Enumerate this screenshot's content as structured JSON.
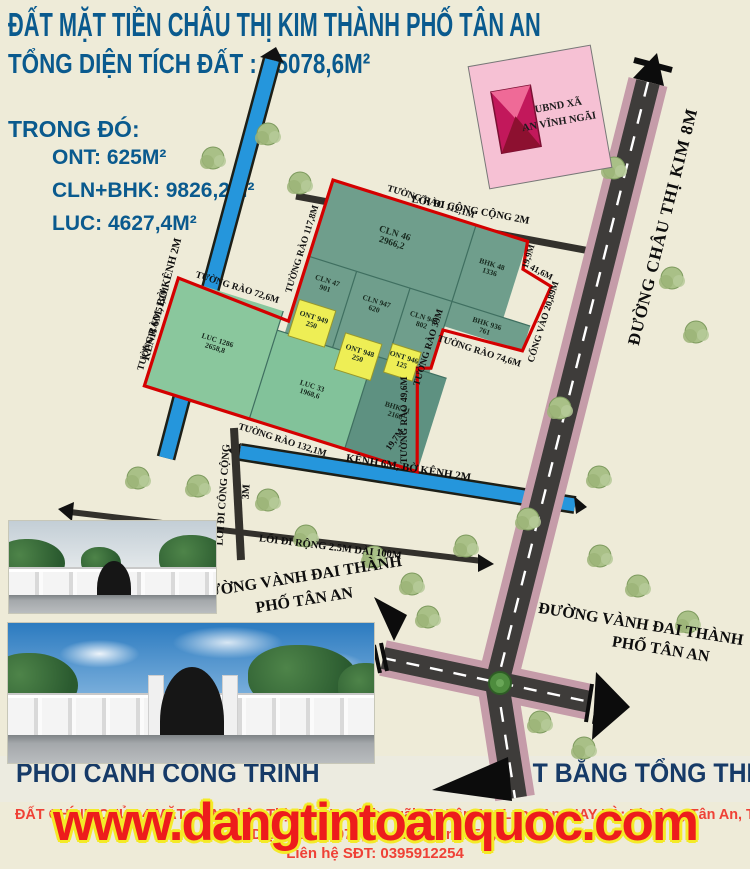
{
  "header": {
    "title": "ĐẤT MẶT TIỀN CHÂU THỊ KIM THÀNH PHỐ TÂN AN",
    "total_area": "TỔNG DIỆN TÍCH ĐẤT : 15078,6M²",
    "breakdown_label": "TRONG ĐÓ:",
    "breakdown": [
      "ONT: 625M²",
      "CLN+BHK: 9826,2M²",
      "LUC: 4627,4M²"
    ]
  },
  "map": {
    "ubnd": {
      "line1": "UBND XÃ",
      "line2": "AN VĨNH NGÃI"
    },
    "roads": {
      "chau_thi_kim": "ĐƯỜNG CHÂU THỊ KIM 8M",
      "vanh_dai_line1": "ĐƯỜNG VÀNH ĐAI THÀNH",
      "vanh_dai_line2": "PHỐ TÂN AN",
      "public_path_2m": "LỐI ĐI CÔNG CỘNG 2M",
      "public_path": "LỐI ĐI CÔNG CỘNG",
      "public_path_width": "3M",
      "canal_left": "KÊNH 6M, BỜ KÊNH 2M",
      "canal_bottom": "KÊNH 6M, BỜ KÊNH 2M",
      "path_100m": "LỐI ĐI RỘNG 2.5M DÀI 100M",
      "gate": "CỔNG VÀO 20,89M"
    },
    "fences": {
      "top": "TƯỜNG RÀO 112,1M",
      "left": "TƯỜNG RÀO 117,8M",
      "luc_top": "TƯỜNG RÀO 72,6M",
      "luc_left": "TƯỜNG RÀO 51,2M",
      "bottom": "TƯỜNG RÀO 132,1M",
      "bhk_bottom": "TƯỜNG RÀO 74,6M",
      "f39": "TƯỜNG RÀO 39M",
      "f49": "TƯỜNG RÀO 49,6M"
    },
    "dims": {
      "d1": "19,9M",
      "d2": "41,6M",
      "d3": "19,7M"
    },
    "plots": [
      {
        "type": "CLN",
        "no": "46",
        "area": "2966,2"
      },
      {
        "type": "CLN",
        "no": "47",
        "area": "901"
      },
      {
        "type": "CLN",
        "no": "947",
        "area": "620"
      },
      {
        "type": "CLN",
        "no": "945",
        "area": "802"
      },
      {
        "type": "BHK",
        "no": "48",
        "area": "1336"
      },
      {
        "type": "BHK",
        "no": "936",
        "area": "761"
      },
      {
        "type": "BHK",
        "no": "31",
        "area": "2168"
      },
      {
        "type": "LUC",
        "no": "1286",
        "area": "2658,8"
      },
      {
        "type": "LUC",
        "no": "33",
        "area": "1968,6"
      },
      {
        "type": "ONT",
        "no": "949",
        "area": "250"
      },
      {
        "type": "ONT",
        "no": "948",
        "area": "250"
      },
      {
        "type": "ONT",
        "no": "946",
        "area": "125"
      }
    ]
  },
  "footer": {
    "caption_left": "PHỐI CẢNH CÔNG TRÌNH",
    "caption_right": "MẶT BẰNG TỔNG THỂ",
    "line1": "ĐẤT CHÍNH CHỦ - 4 MẶT TIỀN Châu Thị Kim, An Vĩnh Ngãi, TP Tân An, Long An. NAY LÀ: Phường Tân An, Tỉnh Tây Ninh",
    "line2": "Diện tích 15078,6m ; Giá bán: 15 tỷ",
    "line3": "Liên hệ SĐT: 0395912254",
    "watermark": "www.dangtintoanquoc.com"
  },
  "colors": {
    "accent_blue": "#0a5a8e",
    "navy": "#163a67",
    "boundary_red": "#d40000",
    "plot_green": "#6f9e8c",
    "ont_yellow": "#eeee55",
    "canal_blue": "#2596dc",
    "road_pink": "#c59ca9",
    "watermark_red": "#ed1c1c",
    "watermark_outline": "#f4ea27"
  }
}
